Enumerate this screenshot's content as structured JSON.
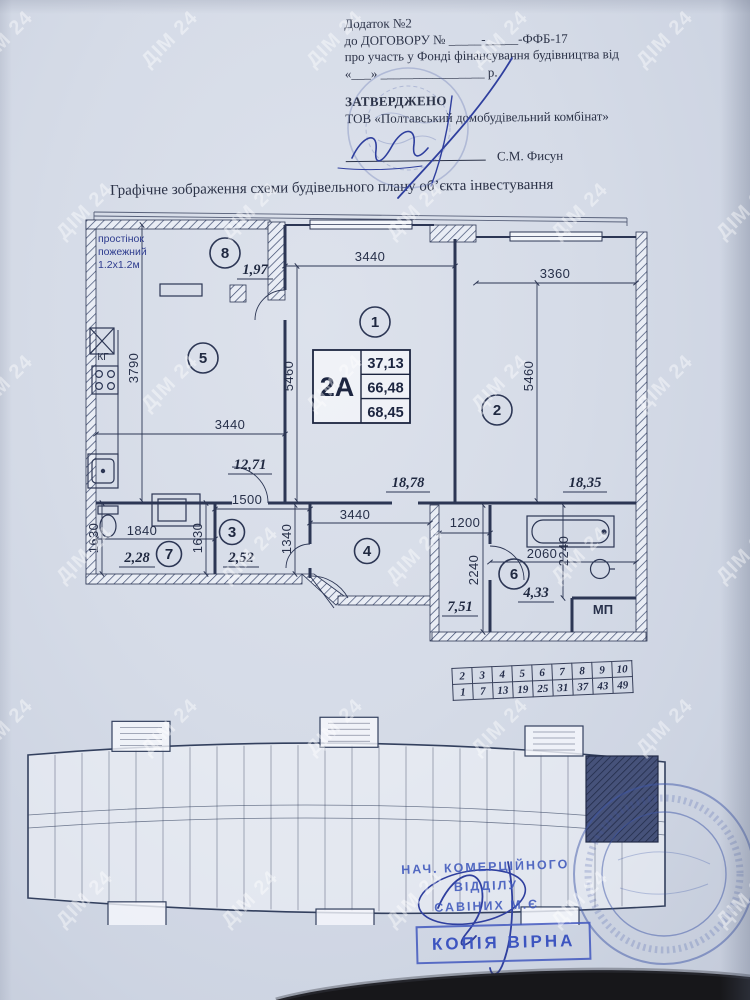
{
  "document": {
    "appendix": "Додаток №2",
    "contract_line": "до ДОГОВОРУ № _____-_____-ФФБ-17",
    "participation_line": "про участь у Фонді фінансування будівництва від",
    "date_line": "«___» ________________ р.",
    "approved_heading": "ЗАТВЕРДЖЕНО",
    "company": "ТОВ «Полтавський домобудівельний комбінат»",
    "signature_name": "С.М. Фисун",
    "title": "Графічне зображення схеми будівельного плану об’єкта інвестування"
  },
  "plan": {
    "fire_note": {
      "line1": "простінок",
      "line2": "пожежний",
      "line3": "1.2х1.2м"
    },
    "apartment": {
      "label": "2А",
      "area_living": "37,13",
      "area_mid": "66,48",
      "area_total": "68,45"
    },
    "rooms": [
      {
        "num": "1",
        "area": "18,78"
      },
      {
        "num": "2",
        "area": "18,35"
      },
      {
        "num": "3",
        "area": "2,52"
      },
      {
        "num": "4",
        "area": "7,51"
      },
      {
        "num": "5",
        "area": "12,71"
      },
      {
        "num": "6",
        "area": "4,33"
      },
      {
        "num": "7",
        "area": "2,28"
      },
      {
        "num": "8",
        "area": "1,97"
      }
    ],
    "dims": [
      "3440",
      "3360",
      "5460",
      "5460",
      "3790",
      "3440",
      "1630",
      "1840",
      "1500",
      "1630",
      "1340",
      "3440",
      "1200",
      "2240",
      "2060",
      "2240"
    ],
    "labels": {
      "kg": "КГ",
      "mp": "МП"
    }
  },
  "floors_table": {
    "row1": [
      "2",
      "3",
      "4",
      "5",
      "6",
      "7",
      "8",
      "9",
      "10"
    ],
    "row2": [
      "1",
      "7",
      "13",
      "19",
      "25",
      "31",
      "37",
      "43",
      "49"
    ]
  },
  "stamps": {
    "dept": {
      "line1": "НАЧ. КОМЕРЦІЙНОГО",
      "line2": "ВІДДІЛУ",
      "line3": "САВІНИХ М.Є"
    },
    "copy_label": "КОПІЯ ВІРНА"
  },
  "watermark": {
    "text": "ДІМ 24"
  },
  "colors": {
    "ink": "#2c3654",
    "stamp_blue": "#4055b8",
    "paper": "#d4dae6"
  }
}
